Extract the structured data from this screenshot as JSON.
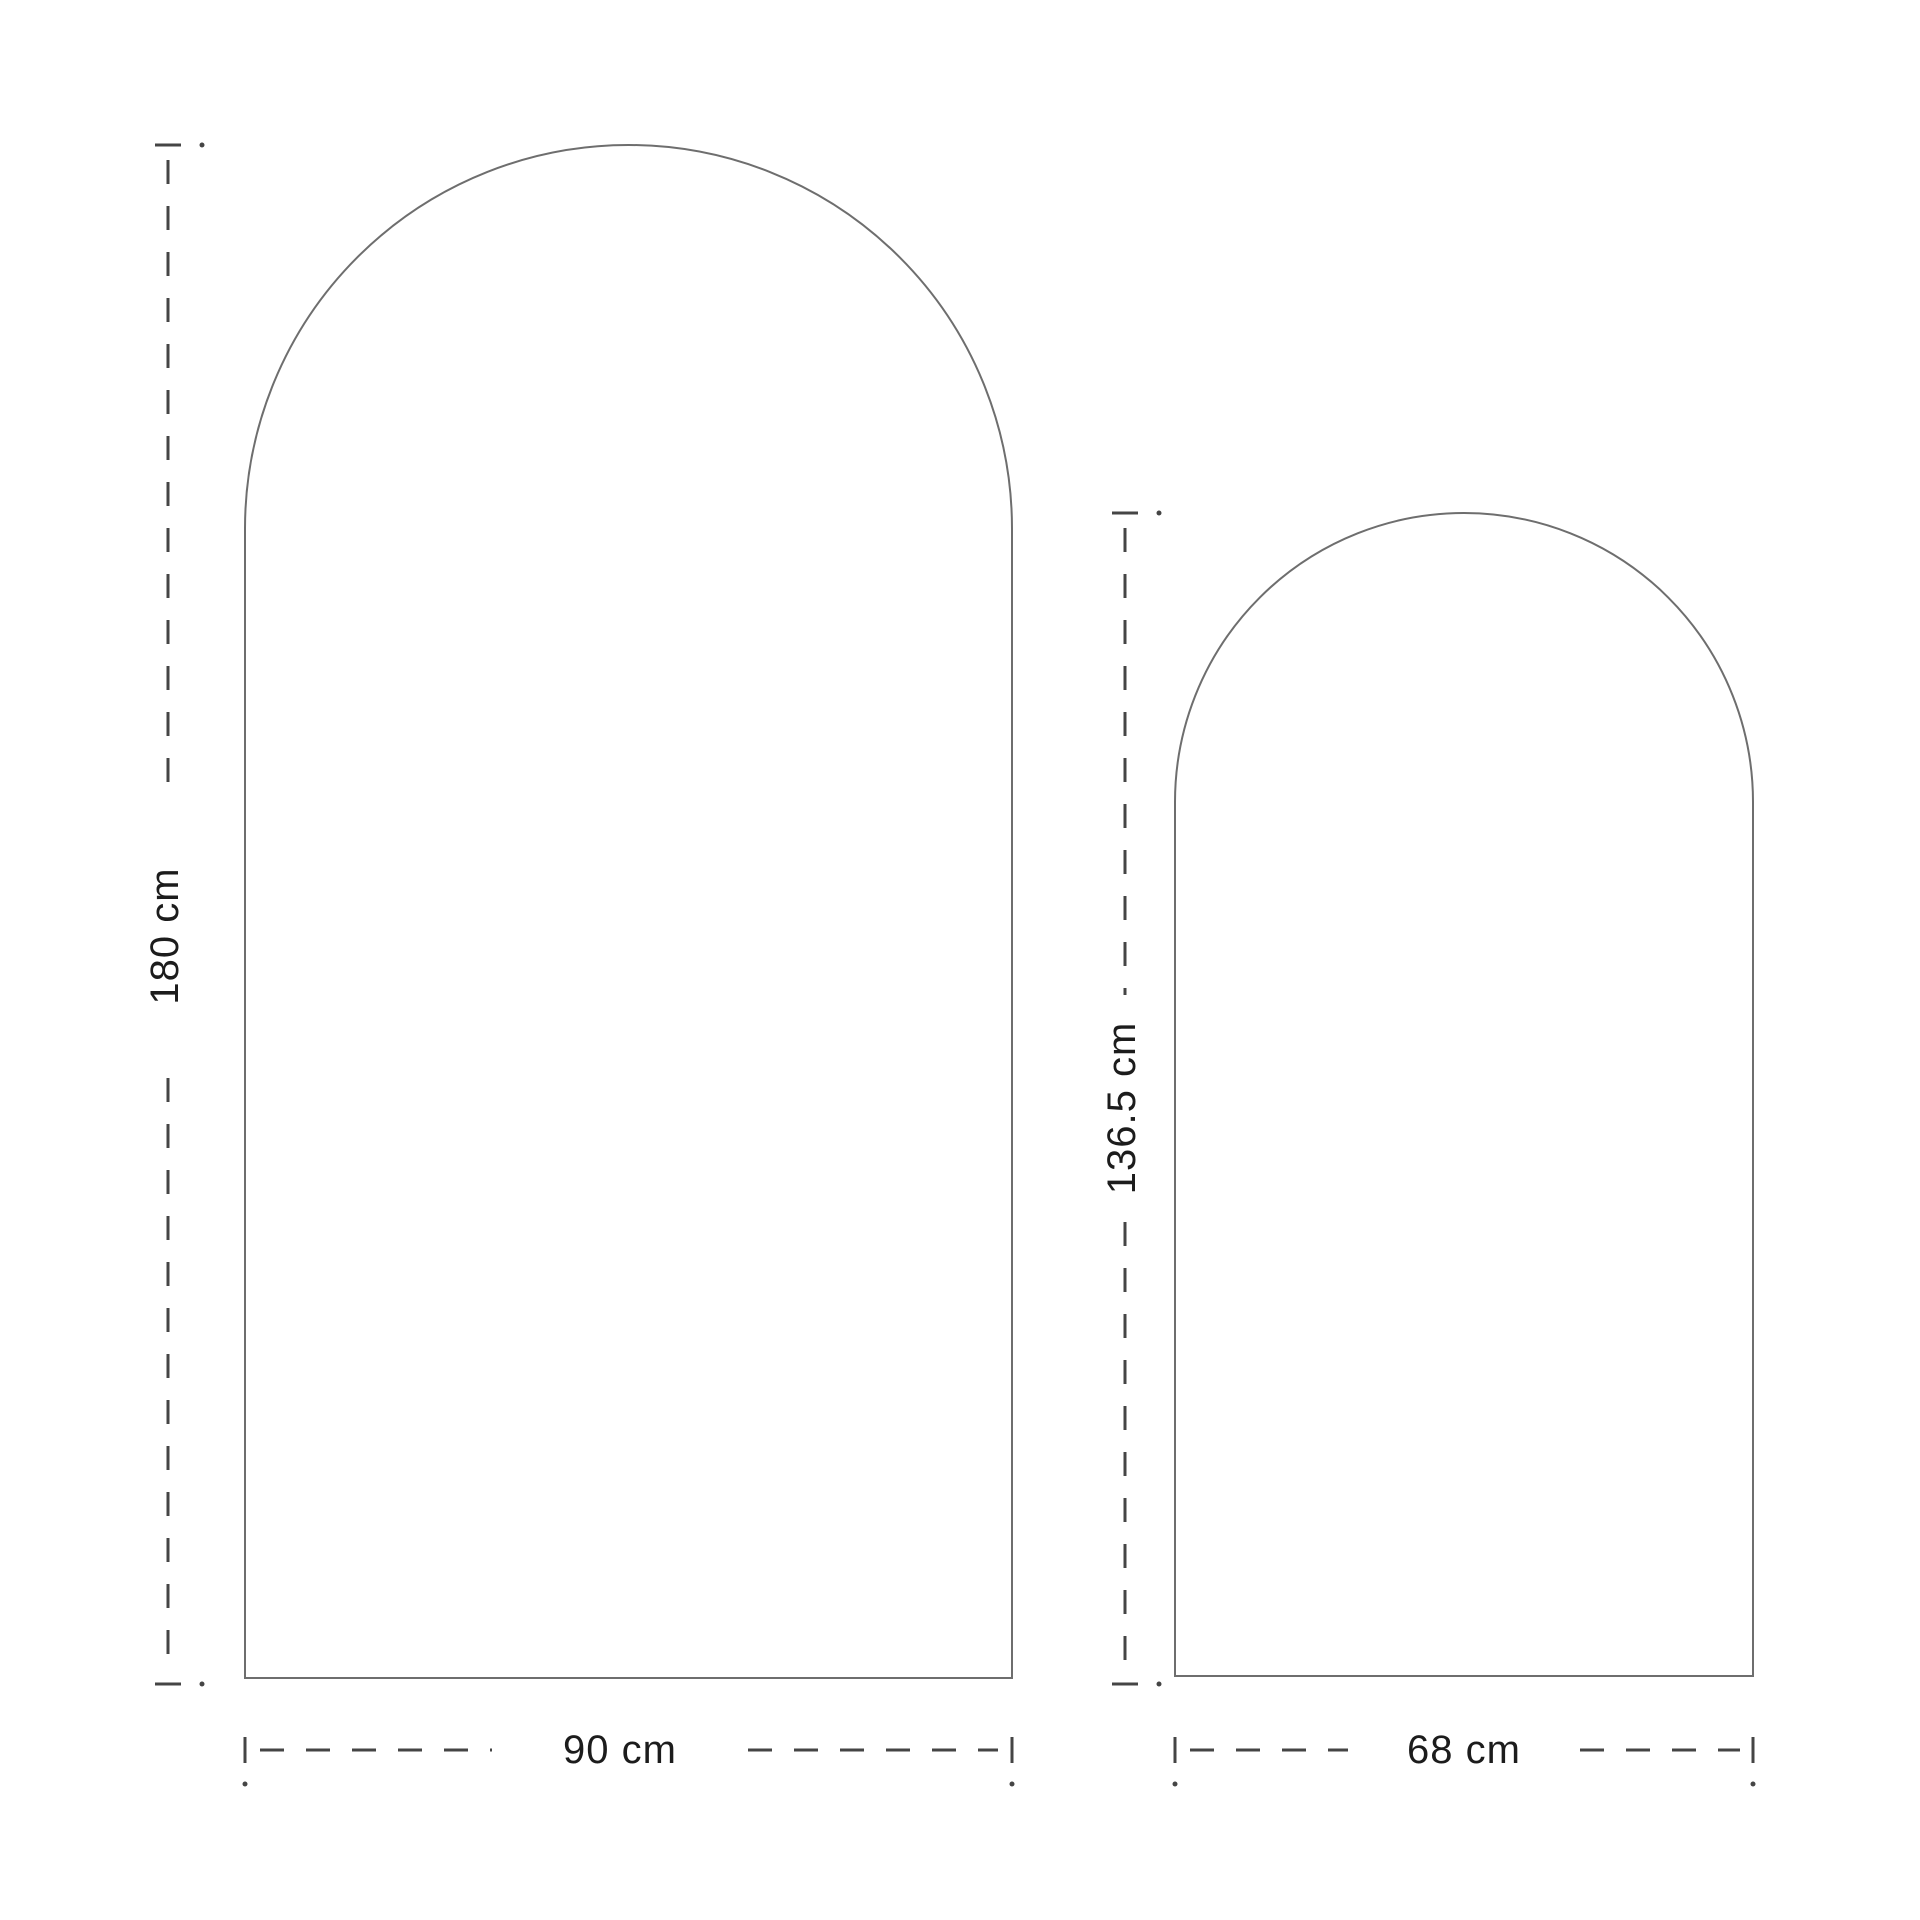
{
  "diagram": {
    "background": "#ffffff",
    "outline_color": "#6e6e6e",
    "dimension_line_color": "#454545",
    "text_color": "#1c1c1c",
    "large_arch": {
      "height_label": "180 cm",
      "width_label": "90 cm",
      "height_cm": 180,
      "width_cm": 90
    },
    "small_arch": {
      "height_label": "136.5 cm",
      "width_label": "68 cm",
      "height_cm": 136.5,
      "width_cm": 68
    }
  }
}
